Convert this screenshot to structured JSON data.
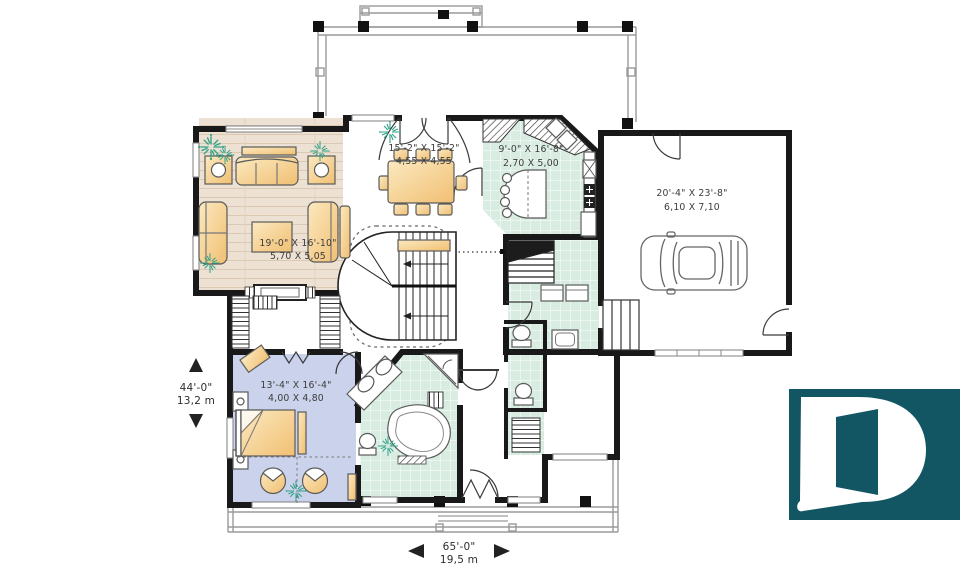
{
  "plan_type": "house-first-floor-plan",
  "rooms": {
    "living_room": {
      "dim_imperial": "19'-0\" X 16'-10\"",
      "dim_metric": "5,70 X 5,05"
    },
    "dining_room": {
      "dim_imperial": "15'-2\" X 15'-2\"",
      "dim_metric": "4,55 X 4,55"
    },
    "kitchen": {
      "dim_imperial": "9'-0\" X 16'-8\"",
      "dim_metric": "2,70 X 5,00"
    },
    "garage": {
      "dim_imperial": "20'-4\" X 23'-8\"",
      "dim_metric": "6,10 X 7,10"
    },
    "master_bedroom": {
      "dim_imperial": "13'-4\" X 16'-4\"",
      "dim_metric": "4,00 X 4,80"
    }
  },
  "overall_dimensions": {
    "depth_imperial": "44'-0\"",
    "depth_metric": "13,2 m",
    "width_imperial": "65'-0\"",
    "width_metric": "19,5 m"
  },
  "logo": {
    "letter": "D"
  },
  "icons": {
    "plant_icon": "starburst-shrub",
    "dimension_arrow_icons": "solid-triangles",
    "logo_icon": "letter-D-with-door-cutout"
  },
  "colors": {
    "wall": "#191919",
    "wood_floor": "#ece1d2",
    "tile_floor": "#d9ece2",
    "carpet_floor": "#cbd3ec",
    "furniture_light": "#fbe9c0",
    "furniture_dark": "#f1bf72",
    "plant": "#2ea189",
    "railing": "#9a9a9a",
    "label_text": "#3c3c3c",
    "logo_background": "#135663",
    "logo_letter": "#ffffff"
  }
}
